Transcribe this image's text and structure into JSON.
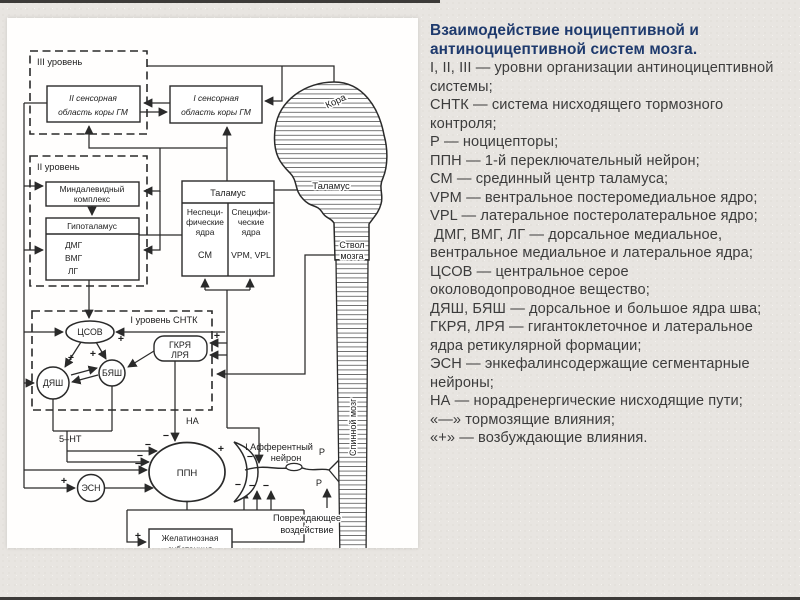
{
  "colors": {
    "background": "#e8e5e1",
    "panel": "#fffefd",
    "diagram_stroke": "#2a2a2a",
    "title_text": "#1e3a6d",
    "body_text": "#3c3c3c"
  },
  "legend": {
    "lines": [
      "Взаимодействие ноцицептивной и",
      "антиноцицептивной систем мозга.",
      "I, II, III — уровни организации антиноцицептивной",
      "системы;",
      "СНТК — система нисходящего тормозного",
      "контроля;",
      "Р — ноцицепторы;",
      "ППН — 1-й переключательный нейрон;",
      "СМ — срединный центр таламуса;",
      "VPM — вентральное постеромедиальное ядро;",
      "VPL — латеральное постеролатеральное ядро;",
      " ДМГ, ВМГ, ЛГ — дорсальное медиальное,",
      "вентральное медиальное и латеральное ядра;",
      "ЦСОВ — центральное серое",
      "околоводопроводное вещество;",
      "ДЯШ, БЯШ — дорсальное и большое ядра шва;",
      "ГКРЯ, ЛРЯ — гигантоклеточное и латеральное",
      "ядра ретикулярной формации;",
      "ЭСН — энкефалинсодержащие сегментарные",
      "нейроны;",
      "НА — норадренергические нисходящие пути;",
      "«—» тормозящие влияния;",
      "«+» — возбуждающие влияния."
    ]
  },
  "diagram": {
    "labels": {
      "lvl3": "III уровень",
      "lvl2": "II уровень",
      "lvl1": "I уровень СНТК",
      "c2a": "II сенсорная",
      "c2b": "область коры ГМ",
      "c1a": "I сенсорная",
      "c1b": "область коры ГМ",
      "amy1": "Миндалевидный",
      "amy2": "комплекс",
      "hyp": "Гипоталамус",
      "dmg": "ДМГ",
      "vmg": "ВМГ",
      "lg": "ЛГ",
      "thal": "Таламус",
      "ns1": "Неспеци-",
      "ns2": "фические",
      "ns3": "ядра",
      "sm": "СМ",
      "sp1": "Специфи-",
      "sp2": "ческие",
      "sp3": "ядра",
      "vpm": "VPM, VPL",
      "kora": "Кора",
      "thal_brain": "Таламус",
      "stvol1": "Ствол",
      "stvol2": "мозга",
      "spinal": "Спинной мозг",
      "tsov": "ЦСОВ",
      "gkrya": "ГКРЯ",
      "lrya": "ЛРЯ",
      "byash": "БЯШ",
      "dyash": "ДЯШ",
      "esn": "ЭСН",
      "ppn": "ППН",
      "na": "НА",
      "ht": "5–НТ",
      "aff1": "I Афферентный",
      "aff2": "нейрон",
      "p": "Р",
      "dam1": "Повреждающее",
      "dam2": "воздействие",
      "gel1": "Желатинозная",
      "gel2": "субстанция"
    },
    "signs": {
      "plus": "+",
      "minus": "−"
    }
  }
}
